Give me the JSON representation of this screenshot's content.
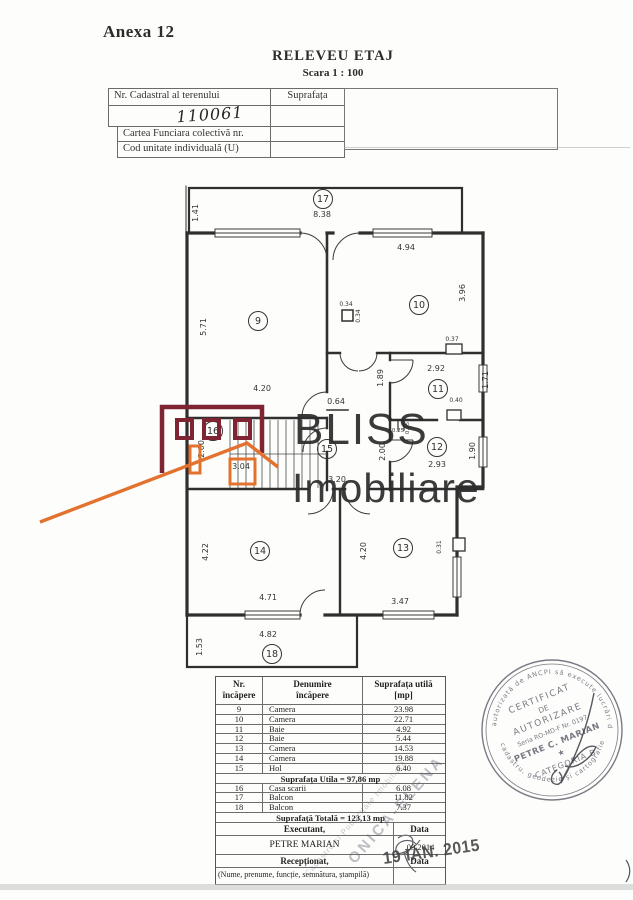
{
  "page": {
    "annex": "Anexa 12",
    "title": "RELEVEU ETAJ",
    "scale": "Scara 1 : 100"
  },
  "cadastral_table": {
    "row1_label": "Nr. Cadastral al terenului",
    "row1_col2": "Suprafața",
    "handwritten_value": "110061",
    "row3_label": "Cartea Funciara colectivă nr.",
    "row4_label": "Cod unitate individuală (U)"
  },
  "watermark": {
    "line1": "BLISS",
    "line2": "Imobiliare",
    "dark_red": "#7e2433",
    "orange": "#e2722e",
    "text_color": "#2b2b2b"
  },
  "floor_plan": {
    "rooms": [
      {
        "num": "17",
        "x": 323,
        "y": 199
      },
      {
        "num": "9",
        "x": 258,
        "y": 321
      },
      {
        "num": "10",
        "x": 419,
        "y": 305
      },
      {
        "num": "11",
        "x": 438,
        "y": 389
      },
      {
        "num": "12",
        "x": 437,
        "y": 447
      },
      {
        "num": "15",
        "x": 327,
        "y": 449
      },
      {
        "num": "16",
        "x": 213,
        "y": 431
      },
      {
        "num": "14",
        "x": 260,
        "y": 551
      },
      {
        "num": "13",
        "x": 403,
        "y": 548
      },
      {
        "num": "18",
        "x": 272,
        "y": 654
      }
    ],
    "dims": [
      {
        "t": "1.41",
        "x": 198,
        "y": 213,
        "r": -90
      },
      {
        "t": "8.38",
        "x": 322,
        "y": 217
      },
      {
        "t": "4.94",
        "x": 406,
        "y": 250
      },
      {
        "t": "3.96",
        "x": 465,
        "y": 293,
        "r": -90
      },
      {
        "t": "5.71",
        "x": 206,
        "y": 327,
        "r": -90
      },
      {
        "t": "4.20",
        "x": 262,
        "y": 391
      },
      {
        "t": "0.34",
        "x": 346,
        "y": 306,
        "s": 6
      },
      {
        "t": "0.34",
        "x": 360,
        "y": 316,
        "r": -90,
        "s": 6
      },
      {
        "t": "0.37",
        "x": 452,
        "y": 341,
        "s": 6
      },
      {
        "t": "2.92",
        "x": 436,
        "y": 371
      },
      {
        "t": "1.71",
        "x": 488,
        "y": 380,
        "r": -90
      },
      {
        "t": "1.89",
        "x": 383,
        "y": 378,
        "r": -90
      },
      {
        "t": "0.40",
        "x": 456,
        "y": 402,
        "s": 6
      },
      {
        "t": "0.64",
        "x": 336,
        "y": 404
      },
      {
        "t": "0.25",
        "x": 398,
        "y": 432,
        "s": 5.5
      },
      {
        "t": "0.25",
        "x": 409,
        "y": 428,
        "r": -90,
        "s": 5.5
      },
      {
        "t": "2.00",
        "x": 385,
        "y": 452,
        "r": -90
      },
      {
        "t": "2.93",
        "x": 437,
        "y": 467
      },
      {
        "t": "1.90",
        "x": 475,
        "y": 451,
        "r": -90
      },
      {
        "t": "2.00",
        "x": 204,
        "y": 449,
        "r": -90
      },
      {
        "t": "3.04",
        "x": 241,
        "y": 469
      },
      {
        "t": "3.20",
        "x": 337,
        "y": 482
      },
      {
        "t": "4.22",
        "x": 208,
        "y": 552,
        "r": -90
      },
      {
        "t": "4.20",
        "x": 366,
        "y": 551,
        "r": -90
      },
      {
        "t": "0.31",
        "x": 441,
        "y": 547,
        "r": -90,
        "s": 6
      },
      {
        "t": "4.71",
        "x": 268,
        "y": 600
      },
      {
        "t": "3.47",
        "x": 400,
        "y": 604
      },
      {
        "t": "4.82",
        "x": 268,
        "y": 637
      },
      {
        "t": "1.53",
        "x": 202,
        "y": 647,
        "r": -90
      }
    ]
  },
  "room_table": {
    "header_col1": "Nr.\nîncăpere",
    "header_col2": "Denumire\nîncăpere",
    "header_col3": "Suprafața utilă\n[mp]",
    "rows": [
      {
        "n": "9",
        "d": "Camera",
        "s": "23.98"
      },
      {
        "n": "10",
        "d": "Camera",
        "s": "22.71"
      },
      {
        "n": "11",
        "d": "Baie",
        "s": "4.92"
      },
      {
        "n": "12",
        "d": "Baie",
        "s": "5.44"
      },
      {
        "n": "13",
        "d": "Camera",
        "s": "14.53"
      },
      {
        "n": "14",
        "d": "Camera",
        "s": "19.88"
      },
      {
        "n": "15",
        "d": "Hol",
        "s": "6.40"
      }
    ],
    "subtotal": "Suprafața Utila = 97,86 mp",
    "rows2": [
      {
        "n": "16",
        "d": "Casa scarii",
        "s": "6.08"
      },
      {
        "n": "17",
        "d": "Balcon",
        "s": "11.82"
      },
      {
        "n": "18",
        "d": "Balcon",
        "s": "7.37"
      }
    ],
    "total": "Suprafață Totală = 123,13 mp",
    "executant_label": "Executant,",
    "data_label_1": "Data",
    "executant_name": "PETRE MARIAN",
    "date_value": ".09.2014",
    "receptionat_label": "Recepționat,",
    "data_label_2": "Data",
    "footnote": "(Nume, prenume, funcție, semnătura, ștampilă)"
  },
  "stamp": {
    "rim_top": "autorizată de ANCPI să execute lucrări de",
    "rim_bottom": "cadastru, geodezie și cartografie",
    "line1": "CERTIFICAT",
    "line2": "DE",
    "line3": "AUTORIZARE",
    "line4": "Seria RO-MD-F Nr. 0197",
    "line5": "PETRE C. MARIAN",
    "line6": "★",
    "line7": "CATEGORIA B"
  },
  "marks": {
    "date_stamp": "19 IAN. 2015",
    "diag_big": "ONICA-ELENA",
    "diag_small": "Cadastru și Publicitate Imobiliară"
  }
}
